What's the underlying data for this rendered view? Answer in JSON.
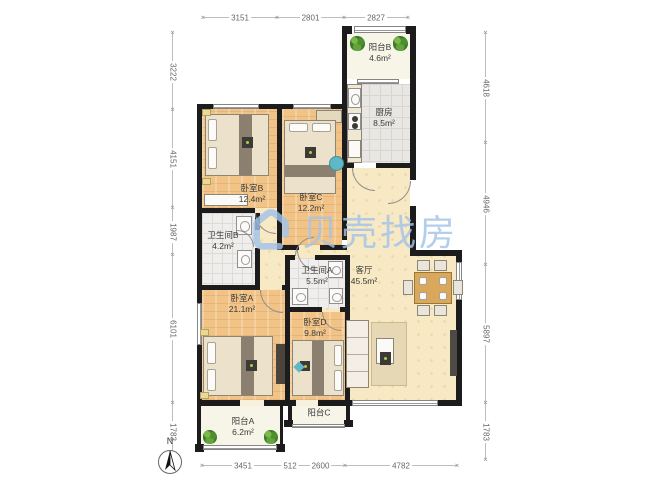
{
  "watermark": {
    "brand": "贝壳找房"
  },
  "compass": {
    "label": "N"
  },
  "rooms": [
    {
      "id": "balcony-b",
      "name": "阳台B",
      "area": "4.6m²"
    },
    {
      "id": "kitchen",
      "name": "厨房",
      "area": "8.5m²"
    },
    {
      "id": "bedroom-b",
      "name": "卧室B",
      "area": "12.4m²"
    },
    {
      "id": "bedroom-c",
      "name": "卧室C",
      "area": "12.2m²"
    },
    {
      "id": "bathroom-b",
      "name": "卫生间B",
      "area": "4.2m²"
    },
    {
      "id": "bathroom-a",
      "name": "卫生间A",
      "area": "5.5m²"
    },
    {
      "id": "living-room",
      "name": "客厅",
      "area": "45.5m²"
    },
    {
      "id": "bedroom-a",
      "name": "卧室A",
      "area": "21.1m²"
    },
    {
      "id": "bedroom-d",
      "name": "卧室D",
      "area": "9.8m²"
    },
    {
      "id": "balcony-c",
      "name": "阳台C",
      "area": ""
    },
    {
      "id": "balcony-a",
      "name": "阳台A",
      "area": "6.2m²"
    }
  ],
  "dimensions": {
    "top": [
      "3151",
      "2801",
      "2827"
    ],
    "bottom": [
      "3451",
      "512",
      "2600",
      "4782"
    ],
    "left": [
      "3222",
      "4151",
      "1987",
      "6101",
      "1783"
    ],
    "right": [
      "4618",
      "4946",
      "5897",
      "1783"
    ]
  },
  "colors": {
    "wall": "#1c1c1c",
    "wood_floor": "#f2c386",
    "living_floor": "#f6e9c4",
    "tile_floor": "#e9e7e3",
    "watermark_blue": "#a3c3e9"
  }
}
